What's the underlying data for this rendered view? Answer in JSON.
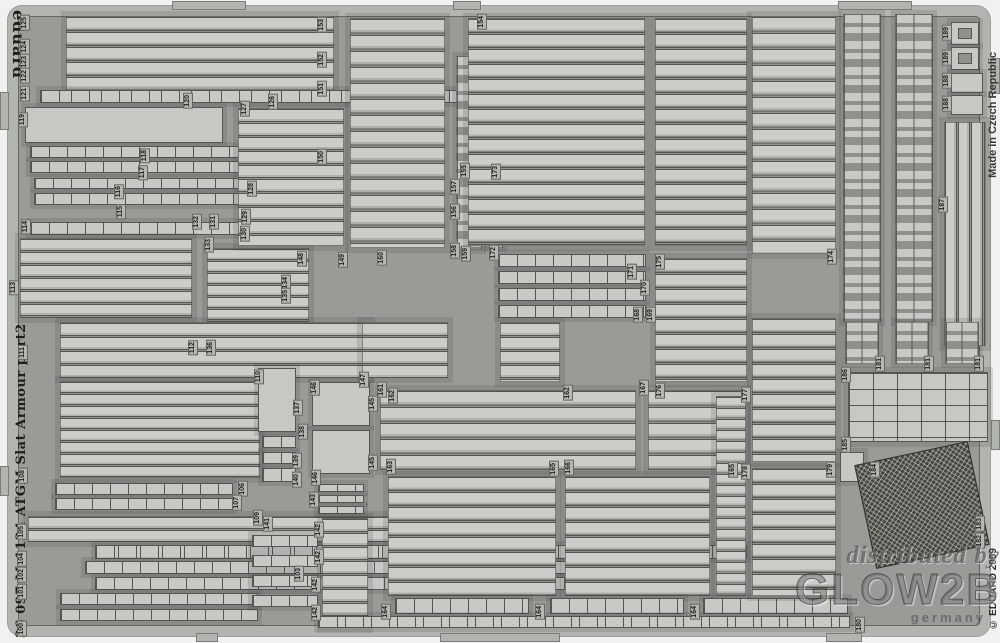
{
  "sheet": {
    "brand": "eduard",
    "made_in": "Made in Czech Republic",
    "copyright": "© EDUARD 2009",
    "edge_title": "36 097   M-1134 ATGM Slat Armour   part2"
  },
  "watermark": {
    "line1": "distributed by",
    "logo": "GLOW2B",
    "country": "germany"
  },
  "colors": {
    "page_bg": "#f1f1ef",
    "sheet_bg": "#999b97",
    "frame": "#b2b4b0",
    "part_light": "#c9cbc7",
    "outline": "#55564f",
    "mesh_dark": "#45463f",
    "label_bg": "#b5b7b3"
  },
  "part_labels": [
    {
      "t": "125",
      "x": 20,
      "y": 15
    },
    {
      "t": "124",
      "x": 20,
      "y": 39
    },
    {
      "t": "123",
      "x": 20,
      "y": 54
    },
    {
      "t": "122",
      "x": 20,
      "y": 68
    },
    {
      "t": "121",
      "x": 20,
      "y": 86
    },
    {
      "t": "120",
      "x": 183,
      "y": 93
    },
    {
      "t": "119",
      "x": 18,
      "y": 112
    },
    {
      "t": "118",
      "x": 140,
      "y": 148
    },
    {
      "t": "117",
      "x": 138,
      "y": 165
    },
    {
      "t": "116",
      "x": 114,
      "y": 184
    },
    {
      "t": "115",
      "x": 116,
      "y": 204
    },
    {
      "t": "114",
      "x": 21,
      "y": 219
    },
    {
      "t": "113",
      "x": 9,
      "y": 280
    },
    {
      "t": "126",
      "x": 268,
      "y": 94
    },
    {
      "t": "127",
      "x": 240,
      "y": 101
    },
    {
      "t": "128",
      "x": 247,
      "y": 181
    },
    {
      "t": "129",
      "x": 241,
      "y": 209
    },
    {
      "t": "130",
      "x": 240,
      "y": 226
    },
    {
      "t": "131",
      "x": 209,
      "y": 214
    },
    {
      "t": "132",
      "x": 192,
      "y": 214
    },
    {
      "t": "133",
      "x": 204,
      "y": 237
    },
    {
      "t": "153",
      "x": 317,
      "y": 17
    },
    {
      "t": "152",
      "x": 317,
      "y": 52
    },
    {
      "t": "151",
      "x": 317,
      "y": 81
    },
    {
      "t": "150",
      "x": 317,
      "y": 149
    },
    {
      "t": "154",
      "x": 477,
      "y": 14
    },
    {
      "t": "155",
      "x": 460,
      "y": 163
    },
    {
      "t": "157",
      "x": 450,
      "y": 179
    },
    {
      "t": "156",
      "x": 450,
      "y": 204
    },
    {
      "t": "158",
      "x": 450,
      "y": 243
    },
    {
      "t": "159",
      "x": 461,
      "y": 246
    },
    {
      "t": "148",
      "x": 297,
      "y": 251
    },
    {
      "t": "149",
      "x": 338,
      "y": 252
    },
    {
      "t": "160",
      "x": 377,
      "y": 250
    },
    {
      "t": "173",
      "x": 491,
      "y": 164
    },
    {
      "t": "172",
      "x": 489,
      "y": 245
    },
    {
      "t": "175",
      "x": 655,
      "y": 254
    },
    {
      "t": "171",
      "x": 627,
      "y": 264
    },
    {
      "t": "170",
      "x": 640,
      "y": 280
    },
    {
      "t": "168",
      "x": 633,
      "y": 307
    },
    {
      "t": "169",
      "x": 646,
      "y": 307
    },
    {
      "t": "174",
      "x": 827,
      "y": 249
    },
    {
      "t": "187",
      "x": 938,
      "y": 197
    },
    {
      "t": "189",
      "x": 942,
      "y": 25
    },
    {
      "t": "189",
      "x": 942,
      "y": 50
    },
    {
      "t": "188",
      "x": 942,
      "y": 73
    },
    {
      "t": "188",
      "x": 942,
      "y": 96
    },
    {
      "t": "111",
      "x": 18,
      "y": 345
    },
    {
      "t": "112",
      "x": 188,
      "y": 340
    },
    {
      "t": "136",
      "x": 206,
      "y": 340
    },
    {
      "t": "108",
      "x": 18,
      "y": 468
    },
    {
      "t": "110",
      "x": 254,
      "y": 369
    },
    {
      "t": "137",
      "x": 293,
      "y": 400
    },
    {
      "t": "138",
      "x": 298,
      "y": 424
    },
    {
      "t": "139",
      "x": 292,
      "y": 453
    },
    {
      "t": "140",
      "x": 292,
      "y": 472
    },
    {
      "t": "141",
      "x": 263,
      "y": 516
    },
    {
      "t": "143",
      "x": 309,
      "y": 492
    },
    {
      "t": "142",
      "x": 314,
      "y": 522
    },
    {
      "t": "142",
      "x": 314,
      "y": 549
    },
    {
      "t": "142",
      "x": 311,
      "y": 577
    },
    {
      "t": "142",
      "x": 311,
      "y": 605
    },
    {
      "t": "145",
      "x": 368,
      "y": 396
    },
    {
      "t": "145",
      "x": 368,
      "y": 455
    },
    {
      "t": "146",
      "x": 310,
      "y": 380
    },
    {
      "t": "146",
      "x": 311,
      "y": 470
    },
    {
      "t": "147",
      "x": 359,
      "y": 372
    },
    {
      "t": "161",
      "x": 377,
      "y": 382
    },
    {
      "t": "162",
      "x": 388,
      "y": 388
    },
    {
      "t": "162",
      "x": 563,
      "y": 385
    },
    {
      "t": "163",
      "x": 386,
      "y": 459
    },
    {
      "t": "167",
      "x": 639,
      "y": 380
    },
    {
      "t": "176",
      "x": 655,
      "y": 383
    },
    {
      "t": "177",
      "x": 741,
      "y": 387
    },
    {
      "t": "178",
      "x": 741,
      "y": 464
    },
    {
      "t": "165",
      "x": 549,
      "y": 461
    },
    {
      "t": "166",
      "x": 564,
      "y": 460
    },
    {
      "t": "165",
      "x": 728,
      "y": 462
    },
    {
      "t": "164",
      "x": 381,
      "y": 604
    },
    {
      "t": "164",
      "x": 535,
      "y": 604
    },
    {
      "t": "164",
      "x": 690,
      "y": 604
    },
    {
      "t": "106",
      "x": 238,
      "y": 481
    },
    {
      "t": "107",
      "x": 232,
      "y": 495
    },
    {
      "t": "109",
      "x": 253,
      "y": 510
    },
    {
      "t": "105",
      "x": 17,
      "y": 524
    },
    {
      "t": "104",
      "x": 17,
      "y": 551
    },
    {
      "t": "102",
      "x": 17,
      "y": 567
    },
    {
      "t": "101",
      "x": 17,
      "y": 584
    },
    {
      "t": "100",
      "x": 17,
      "y": 621
    },
    {
      "t": "103",
      "x": 294,
      "y": 566
    },
    {
      "t": "179",
      "x": 826,
      "y": 462
    },
    {
      "t": "180",
      "x": 855,
      "y": 617
    },
    {
      "t": "181",
      "x": 875,
      "y": 356
    },
    {
      "t": "181",
      "x": 924,
      "y": 356
    },
    {
      "t": "181",
      "x": 974,
      "y": 356
    },
    {
      "t": "184",
      "x": 870,
      "y": 462
    },
    {
      "t": "185",
      "x": 841,
      "y": 437
    },
    {
      "t": "186",
      "x": 841,
      "y": 367
    },
    {
      "t": "182",
      "x": 975,
      "y": 533
    },
    {
      "t": "183",
      "x": 975,
      "y": 516
    },
    {
      "t": "134",
      "x": 281,
      "y": 275
    },
    {
      "t": "135",
      "x": 281,
      "y": 288
    }
  ],
  "groups": [
    {
      "x": 66,
      "y": 16,
      "w": 268,
      "h": 76,
      "k": "hslats",
      "bs": "100% 15px"
    },
    {
      "x": 40,
      "y": 90,
      "w": 496,
      "h": 13,
      "k": "hseg",
      "bs": "30px 100%"
    },
    {
      "x": 25,
      "y": 107,
      "w": 198,
      "h": 36,
      "k": "plain"
    },
    {
      "x": 30,
      "y": 146,
      "w": 272,
      "h": 12,
      "k": "hseg"
    },
    {
      "x": 30,
      "y": 161,
      "w": 272,
      "h": 12,
      "k": "hseg"
    },
    {
      "x": 34,
      "y": 178,
      "w": 216,
      "h": 11,
      "k": "hseg"
    },
    {
      "x": 34,
      "y": 193,
      "w": 242,
      "h": 12,
      "k": "hseg"
    },
    {
      "x": 30,
      "y": 222,
      "w": 250,
      "h": 13,
      "k": "hseg"
    },
    {
      "x": 20,
      "y": 238,
      "w": 172,
      "h": 80,
      "k": "hslats",
      "bs": "100% 13px"
    },
    {
      "x": 207,
      "y": 248,
      "w": 102,
      "h": 76,
      "k": "hslats",
      "bs": "100% 12px"
    },
    {
      "x": 238,
      "y": 108,
      "w": 106,
      "h": 138,
      "k": "hslats",
      "bs": "100% 14px"
    },
    {
      "x": 350,
      "y": 18,
      "w": 95,
      "h": 230,
      "k": "hslats",
      "bs": "100% 16px"
    },
    {
      "x": 456,
      "y": 56,
      "w": 26,
      "h": 194,
      "k": "clips"
    },
    {
      "x": 488,
      "y": 166,
      "w": 15,
      "h": 82,
      "k": "clips"
    },
    {
      "x": 468,
      "y": 18,
      "w": 177,
      "h": 228,
      "k": "hslats",
      "bs": "100% 15px"
    },
    {
      "x": 655,
      "y": 18,
      "w": 92,
      "h": 228,
      "k": "hslats",
      "bs": "100% 15px"
    },
    {
      "x": 752,
      "y": 16,
      "w": 84,
      "h": 238,
      "k": "hslats",
      "bs": "100% 16px"
    },
    {
      "x": 843,
      "y": 14,
      "w": 38,
      "h": 308,
      "k": "clips"
    },
    {
      "x": 895,
      "y": 14,
      "w": 38,
      "h": 308,
      "k": "clips"
    },
    {
      "x": 951,
      "y": 22,
      "w": 28,
      "h": 23,
      "k": "ring"
    },
    {
      "x": 951,
      "y": 47,
      "w": 28,
      "h": 23,
      "k": "ring"
    },
    {
      "x": 951,
      "y": 73,
      "w": 32,
      "h": 20,
      "k": "plain"
    },
    {
      "x": 951,
      "y": 95,
      "w": 32,
      "h": 20,
      "k": "plain"
    },
    {
      "x": 944,
      "y": 122,
      "w": 42,
      "h": 224,
      "k": "vslats",
      "bs": "13px 100%"
    },
    {
      "x": 498,
      "y": 254,
      "w": 148,
      "h": 13,
      "k": "hseg"
    },
    {
      "x": 498,
      "y": 271,
      "w": 148,
      "h": 13,
      "k": "hseg"
    },
    {
      "x": 498,
      "y": 288,
      "w": 148,
      "h": 13,
      "k": "hseg"
    },
    {
      "x": 498,
      "y": 305,
      "w": 148,
      "h": 13,
      "k": "hseg"
    },
    {
      "x": 655,
      "y": 258,
      "w": 92,
      "h": 124,
      "k": "hslats",
      "bs": "100% 15px"
    },
    {
      "x": 752,
      "y": 318,
      "w": 84,
      "h": 144,
      "k": "hslats",
      "bs": "100% 15px"
    },
    {
      "x": 60,
      "y": 322,
      "w": 310,
      "h": 56,
      "k": "hslats",
      "bs": "100% 14px"
    },
    {
      "x": 362,
      "y": 322,
      "w": 86,
      "h": 56,
      "k": "hslats",
      "bs": "100% 14px"
    },
    {
      "x": 500,
      "y": 322,
      "w": 60,
      "h": 60,
      "k": "hslats",
      "bs": "100% 14px"
    },
    {
      "x": 60,
      "y": 381,
      "w": 200,
      "h": 97,
      "k": "hslats",
      "bs": "100% 12px"
    },
    {
      "x": 258,
      "y": 368,
      "w": 38,
      "h": 64,
      "k": "plain"
    },
    {
      "x": 262,
      "y": 436,
      "w": 34,
      "h": 12,
      "k": "hseg"
    },
    {
      "x": 262,
      "y": 452,
      "w": 34,
      "h": 12,
      "k": "hseg"
    },
    {
      "x": 262,
      "y": 468,
      "w": 34,
      "h": 14,
      "k": "hseg"
    },
    {
      "x": 312,
      "y": 382,
      "w": 58,
      "h": 44,
      "k": "plain"
    },
    {
      "x": 312,
      "y": 430,
      "w": 58,
      "h": 44,
      "k": "plain"
    },
    {
      "x": 380,
      "y": 390,
      "w": 256,
      "h": 80,
      "k": "hslats",
      "bs": "100% 16px"
    },
    {
      "x": 648,
      "y": 390,
      "w": 98,
      "h": 80,
      "k": "hslats",
      "bs": "100% 16px"
    },
    {
      "x": 55,
      "y": 483,
      "w": 178,
      "h": 12,
      "k": "hseg"
    },
    {
      "x": 55,
      "y": 498,
      "w": 178,
      "h": 12,
      "k": "hseg"
    },
    {
      "x": 28,
      "y": 516,
      "w": 432,
      "h": 26,
      "k": "hslats",
      "bs": "100% 13px"
    },
    {
      "x": 95,
      "y": 545,
      "w": 652,
      "h": 14,
      "k": "hseg",
      "bs": "22px 100%"
    },
    {
      "x": 85,
      "y": 561,
      "w": 572,
      "h": 13,
      "k": "hseg"
    },
    {
      "x": 95,
      "y": 577,
      "w": 572,
      "h": 13,
      "k": "hseg"
    },
    {
      "x": 60,
      "y": 593,
      "w": 198,
      "h": 12,
      "k": "hseg"
    },
    {
      "x": 60,
      "y": 609,
      "w": 198,
      "h": 12,
      "k": "hseg"
    },
    {
      "x": 252,
      "y": 535,
      "w": 66,
      "h": 12,
      "k": "hseg"
    },
    {
      "x": 252,
      "y": 555,
      "w": 66,
      "h": 12,
      "k": "hseg"
    },
    {
      "x": 252,
      "y": 575,
      "w": 66,
      "h": 12,
      "k": "hseg"
    },
    {
      "x": 252,
      "y": 595,
      "w": 66,
      "h": 12,
      "k": "hseg"
    },
    {
      "x": 318,
      "y": 484,
      "w": 46,
      "h": 8,
      "k": "hseg"
    },
    {
      "x": 318,
      "y": 495,
      "w": 46,
      "h": 8,
      "k": "hseg"
    },
    {
      "x": 318,
      "y": 506,
      "w": 46,
      "h": 8,
      "k": "hseg"
    },
    {
      "x": 322,
      "y": 518,
      "w": 46,
      "h": 110,
      "k": "hslats",
      "bs": "100% 14px"
    },
    {
      "x": 388,
      "y": 476,
      "w": 168,
      "h": 120,
      "k": "hslats",
      "bs": "100% 15px"
    },
    {
      "x": 565,
      "y": 476,
      "w": 145,
      "h": 120,
      "k": "hslats",
      "bs": "100% 15px"
    },
    {
      "x": 716,
      "y": 396,
      "w": 30,
      "h": 200,
      "k": "hslats",
      "bs": "100% 11px"
    },
    {
      "x": 395,
      "y": 598,
      "w": 134,
      "h": 16,
      "k": "hseg"
    },
    {
      "x": 550,
      "y": 598,
      "w": 134,
      "h": 16,
      "k": "hseg"
    },
    {
      "x": 703,
      "y": 598,
      "w": 145,
      "h": 16,
      "k": "hseg"
    },
    {
      "x": 318,
      "y": 616,
      "w": 532,
      "h": 12,
      "k": "hseg",
      "bs": "26px 100%"
    },
    {
      "x": 752,
      "y": 468,
      "w": 84,
      "h": 128,
      "k": "hslats",
      "bs": "100% 15px"
    },
    {
      "x": 845,
      "y": 322,
      "w": 34,
      "h": 42,
      "k": "clips"
    },
    {
      "x": 895,
      "y": 322,
      "w": 34,
      "h": 42,
      "k": "clips"
    },
    {
      "x": 945,
      "y": 322,
      "w": 34,
      "h": 42,
      "k": "clips"
    },
    {
      "x": 848,
      "y": 372,
      "w": 140,
      "h": 70,
      "k": "grid"
    },
    {
      "x": 840,
      "y": 452,
      "w": 24,
      "h": 30,
      "k": "plain"
    },
    {
      "x": 864,
      "y": 452,
      "w": 116,
      "h": 106,
      "k": "mesh",
      "rot": -12
    },
    {
      "x": 172,
      "y": 1,
      "w": 74,
      "h": 9,
      "k": "tab"
    },
    {
      "x": 453,
      "y": 1,
      "w": 28,
      "h": 9,
      "k": "tab"
    },
    {
      "x": 838,
      "y": 1,
      "w": 74,
      "h": 9,
      "k": "tab"
    },
    {
      "x": 196,
      "y": 633,
      "w": 22,
      "h": 9,
      "k": "tab"
    },
    {
      "x": 440,
      "y": 633,
      "w": 120,
      "h": 9,
      "k": "tab"
    },
    {
      "x": 826,
      "y": 633,
      "w": 36,
      "h": 9,
      "k": "tab"
    },
    {
      "x": 0,
      "y": 92,
      "w": 9,
      "h": 38,
      "k": "tab"
    },
    {
      "x": 0,
      "y": 466,
      "w": 9,
      "h": 30,
      "k": "tab"
    },
    {
      "x": 991,
      "y": 58,
      "w": 9,
      "h": 36,
      "k": "tab"
    },
    {
      "x": 991,
      "y": 420,
      "w": 9,
      "h": 30,
      "k": "tab"
    }
  ]
}
